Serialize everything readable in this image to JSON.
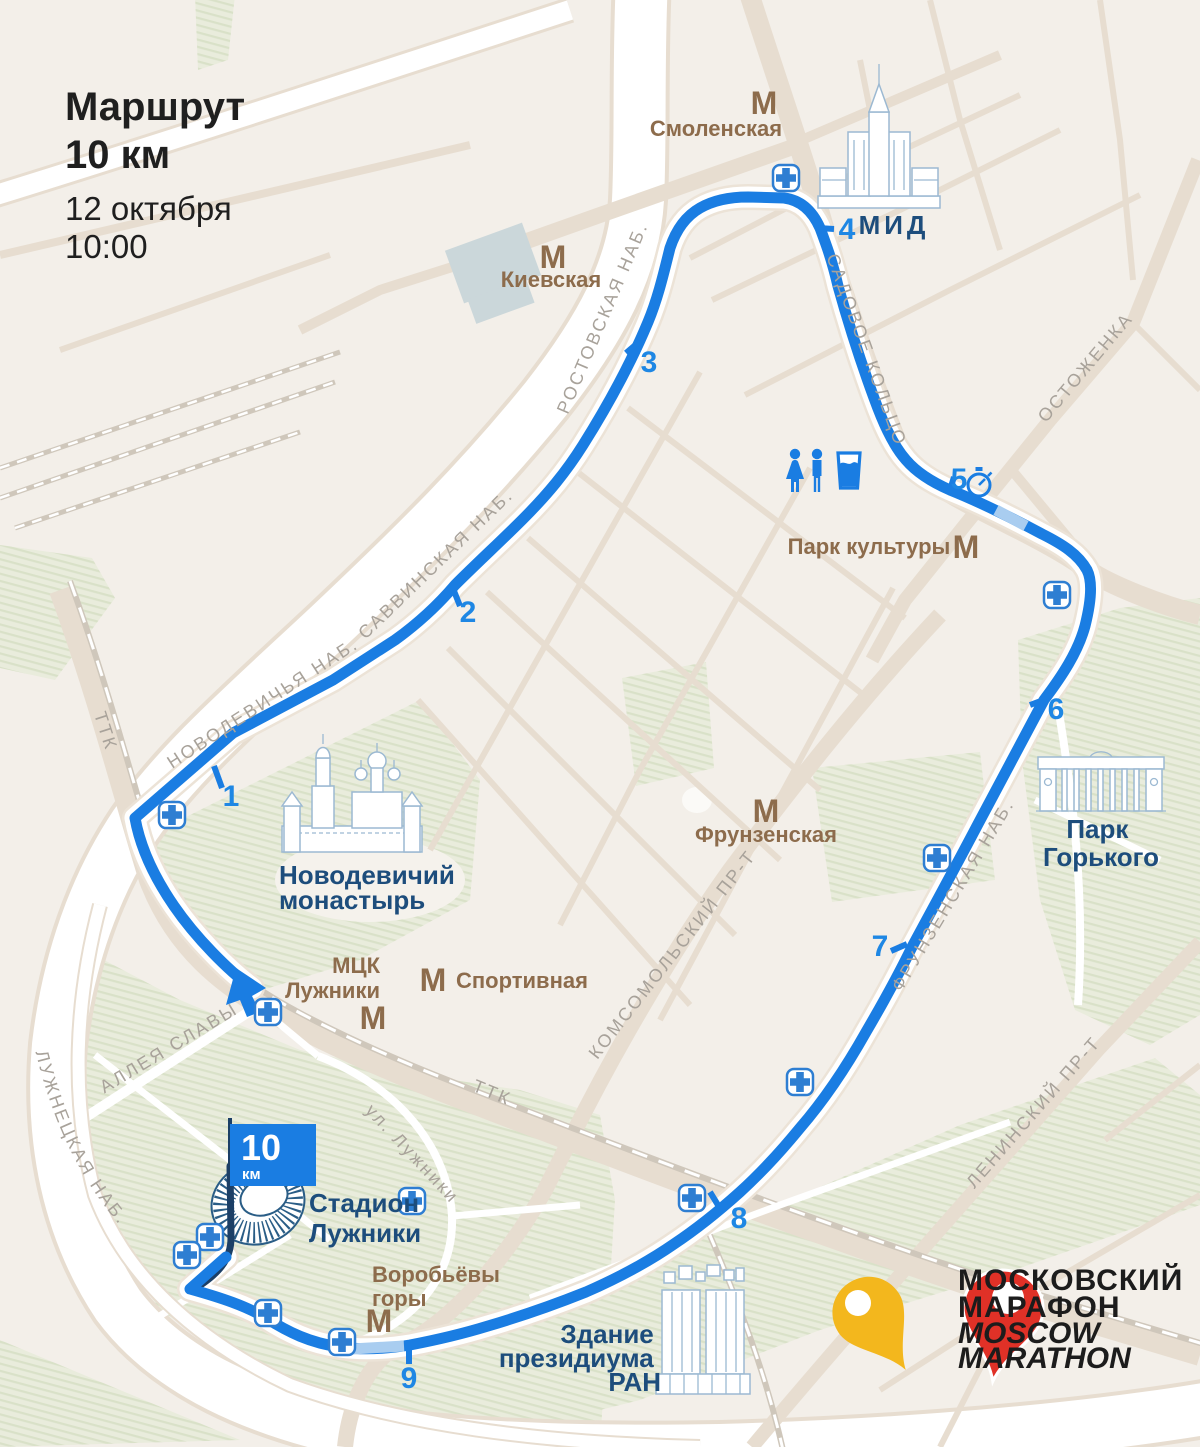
{
  "header": {
    "title_line1": "Маршрут",
    "title_line2": "10 км",
    "date": "12 октября",
    "time": "10:00"
  },
  "finish_flag": {
    "distance": "10",
    "unit": "км"
  },
  "km_markers": [
    {
      "n": "1",
      "tick": [
        214,
        766,
        222,
        788
      ],
      "x": 231,
      "y": 806
    },
    {
      "n": "2",
      "tick": [
        452,
        586,
        460,
        606
      ],
      "x": 468,
      "y": 622
    },
    {
      "n": "3",
      "tick": [
        640,
        341,
        626,
        353
      ],
      "x": 649,
      "y": 372
    },
    {
      "n": "4",
      "tick": [
        818,
        228,
        834,
        229
      ],
      "x": 847,
      "y": 239
    },
    {
      "n": "5",
      "tick": [
        949,
        493,
        954,
        477
      ],
      "x": 959,
      "y": 489
    },
    {
      "n": "6",
      "tick": [
        1046,
        699,
        1030,
        705
      ],
      "x": 1056,
      "y": 719
    },
    {
      "n": "7",
      "tick": [
        907,
        944,
        891,
        951
      ],
      "x": 880,
      "y": 956
    },
    {
      "n": "8",
      "tick": [
        710,
        1192,
        721,
        1210
      ],
      "x": 739,
      "y": 1228
    },
    {
      "n": "9",
      "tick": [
        409,
        1347,
        409,
        1364
      ],
      "x": 409,
      "y": 1388
    }
  ],
  "metro": {
    "icon_glyph": "М",
    "stations": [
      {
        "id": "smolenskaya",
        "icon": [
          764,
          114
        ],
        "anchor": "middle",
        "lines": [
          {
            "t": "Смоленская",
            "x": 716,
            "y": 136
          }
        ]
      },
      {
        "id": "kievskaya",
        "icon": [
          553,
          268
        ],
        "anchor": "middle",
        "lines": [
          {
            "t": "Киевская",
            "x": 551,
            "y": 287
          }
        ]
      },
      {
        "id": "park-kultury",
        "icon": [
          966,
          558
        ],
        "anchor": "middle",
        "lines": [
          {
            "t": "Парк культуры",
            "x": 869,
            "y": 554
          }
        ]
      },
      {
        "id": "frunzenskaya",
        "icon": [
          766,
          822
        ],
        "anchor": "middle",
        "lines": [
          {
            "t": "Фрунзенская",
            "x": 766,
            "y": 842
          }
        ]
      },
      {
        "id": "sportivnaya",
        "icon": [
          433,
          991
        ],
        "anchor": "start",
        "lines": [
          {
            "t": "Спортивная",
            "x": 456,
            "y": 988
          }
        ]
      },
      {
        "id": "mck-luzhniki",
        "icon": [
          373,
          1029
        ],
        "anchor": "end",
        "lines": [
          {
            "t": "МЦК",
            "x": 380,
            "y": 973
          },
          {
            "t": "Лужники",
            "x": 380,
            "y": 998
          }
        ]
      },
      {
        "id": "vorobyovy-gory",
        "icon": [
          379,
          1332
        ],
        "anchor": "start",
        "lines": [
          {
            "t": "Воробьёвы",
            "x": 372,
            "y": 1282
          },
          {
            "t": "горы",
            "x": 372,
            "y": 1306
          }
        ]
      }
    ]
  },
  "streets": [
    {
      "t": "НОВОДЕВИЧЬЯ НАБ.",
      "x": 266,
      "y": 708,
      "a": -33
    },
    {
      "t": "САВВИНСКАЯ НАБ.",
      "x": 440,
      "y": 568,
      "a": -44
    },
    {
      "t": "РОСТОВСКАЯ НАБ.",
      "x": 608,
      "y": 320,
      "a": -67
    },
    {
      "t": "САДОВОЕ КОЛЬЦО",
      "x": 861,
      "y": 352,
      "a": 70
    },
    {
      "t": "ОСТОЖЕНКА",
      "x": 1090,
      "y": 371,
      "a": -50
    },
    {
      "t": "ТТК",
      "x": 100,
      "y": 733,
      "a": 72
    },
    {
      "t": "ТТК",
      "x": 490,
      "y": 1098,
      "a": 22
    },
    {
      "t": "КОМСОМОЛЬСКИЙ ПР-Т",
      "x": 677,
      "y": 958,
      "a": -52
    },
    {
      "t": "ФРУНЗЕНСКАЯ НАБ.",
      "x": 958,
      "y": 898,
      "a": -59
    },
    {
      "t": "ЛЕНИНСКИЙ ПР-Т",
      "x": 1038,
      "y": 1116,
      "a": -49
    },
    {
      "t": "АЛЛЕЯ СЛАВЫ",
      "x": 172,
      "y": 1053,
      "a": -31
    },
    {
      "t": "ул. Лужники",
      "x": 408,
      "y": 1158,
      "a": 47
    }
  ],
  "street_curved": {
    "luzhnetskaya": "ЛУЖНЕЦКАЯ НАБ."
  },
  "landmarks": {
    "mid": "МИД",
    "novodevichy": [
      "Новодевичий",
      "монастырь"
    ],
    "gorky": [
      "Парк",
      "Горького"
    ],
    "stadium": [
      "Стадион",
      "Лужники"
    ],
    "ran": [
      "Здание",
      "президиума",
      "РАН"
    ]
  },
  "facilities": {
    "medical_points": [
      [
        786,
        178
      ],
      [
        1057,
        595
      ],
      [
        937,
        858
      ],
      [
        800,
        1082
      ],
      [
        692,
        1198
      ],
      [
        172,
        815
      ],
      [
        268,
        1012
      ],
      [
        412,
        1201
      ],
      [
        210,
        1237
      ],
      [
        187,
        1255
      ],
      [
        268,
        1313
      ],
      [
        342,
        1342
      ]
    ],
    "toilets": [
      [
        795,
        470
      ],
      [
        817,
        470
      ]
    ],
    "water": [
      849,
      470
    ],
    "timing_checkpoint": [
      979,
      483
    ]
  },
  "logo": {
    "line1": "МОСКОВСКИЙ",
    "line2": "МАРАФОН",
    "line3": "MOSCOW",
    "line4": "MARATHON"
  },
  "colors": {
    "route_blue": "#1a7de2",
    "route_underpass": "#a9cdf0",
    "finish_navy": "#1c3f66",
    "label_navy": "#1d4d7c",
    "metro_brown": "#8d6c4c",
    "street_gray": "#a8a29a",
    "background": "#f3efe9",
    "road_beige": "#e7ddd0",
    "park_green": "#e9ecdc",
    "park_hatch": "#d9e1c8",
    "station_block": "#cbd7da",
    "logo_yellow": "#f3b71d",
    "logo_red": "#e03127"
  }
}
